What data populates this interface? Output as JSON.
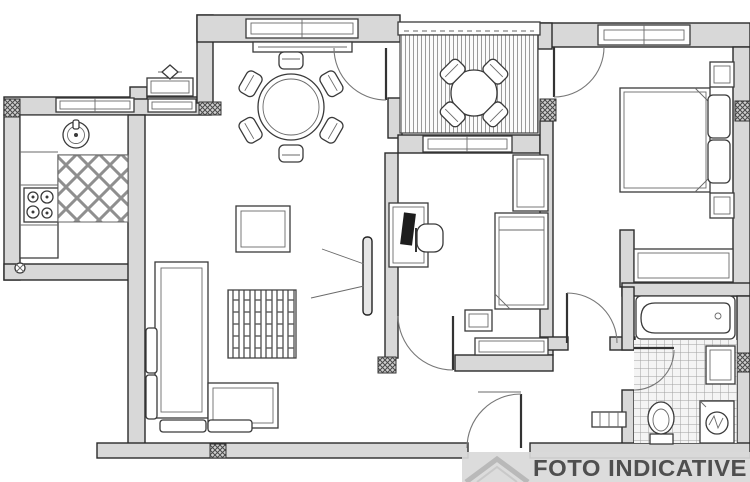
{
  "watermark": {
    "label": "FOTO INDICATIVE"
  },
  "palette": {
    "background": "#ffffff",
    "wall_fill": "#d8d8d8",
    "wall_outline": "#2b2b2b",
    "furniture_outline": "#3a3a3a",
    "tile_line": "#a0a0a0",
    "watermark_band": "#d9d9d9",
    "watermark_text": "#4f4f4f",
    "logo_gray": "#b9b9b9"
  },
  "floorplan": {
    "type": "apartment-floor-plan",
    "rooms": [
      {
        "key": "kitchen",
        "glyphs": [
          "kitchen-counter",
          "kitchen-sink-icon",
          "stove-burners-icon",
          "diamond-tile-floor",
          "kitchen-window-1",
          "kitchen-window-2",
          "radiator-icon",
          "valve-icon"
        ]
      },
      {
        "key": "dining",
        "glyphs": [
          "round-dining-table-icon",
          "dining-chair-icon-x6",
          "dining-window",
          "window-sill-radiator"
        ]
      },
      {
        "key": "balcony",
        "glyphs": [
          "deck-floor",
          "balcony-parapet",
          "balcony-table-icon",
          "balcony-chair-icon-x4"
        ]
      },
      {
        "key": "living",
        "glyphs": [
          "corner-sofa-icon",
          "coffee-table-icon",
          "striped-rug-icon",
          "tv-icon"
        ]
      },
      {
        "key": "study",
        "glyphs": [
          "desk-icon",
          "monitor-icon",
          "desk-chair-icon",
          "single-bed-icon",
          "wardrobe-icon",
          "nightstand-icon",
          "dresser-icon",
          "study-window"
        ]
      },
      {
        "key": "bedroom",
        "glyphs": [
          "double-bed-icon",
          "pillow-icon-x2",
          "nightstand-icon-x2",
          "bedroom-window",
          "bedroom-wardrobe-icon"
        ]
      },
      {
        "key": "bathroom",
        "glyphs": [
          "bathtub-icon",
          "toilet-icon",
          "washing-machine-icon",
          "bathroom-sink-icon",
          "square-tile-floor"
        ]
      },
      {
        "key": "hallway",
        "glyphs": [
          "entrance-door-icon",
          "radiator-icon"
        ]
      }
    ],
    "doors": [
      "entrance-door",
      "study-door",
      "bedroom-corridor-door",
      "bathroom-door",
      "dining-balcony-door",
      "bedroom-balcony-door"
    ],
    "windows": [
      "kitchen-window-1",
      "kitchen-window-2",
      "dining-window",
      "study-window",
      "bedroom-window"
    ]
  }
}
